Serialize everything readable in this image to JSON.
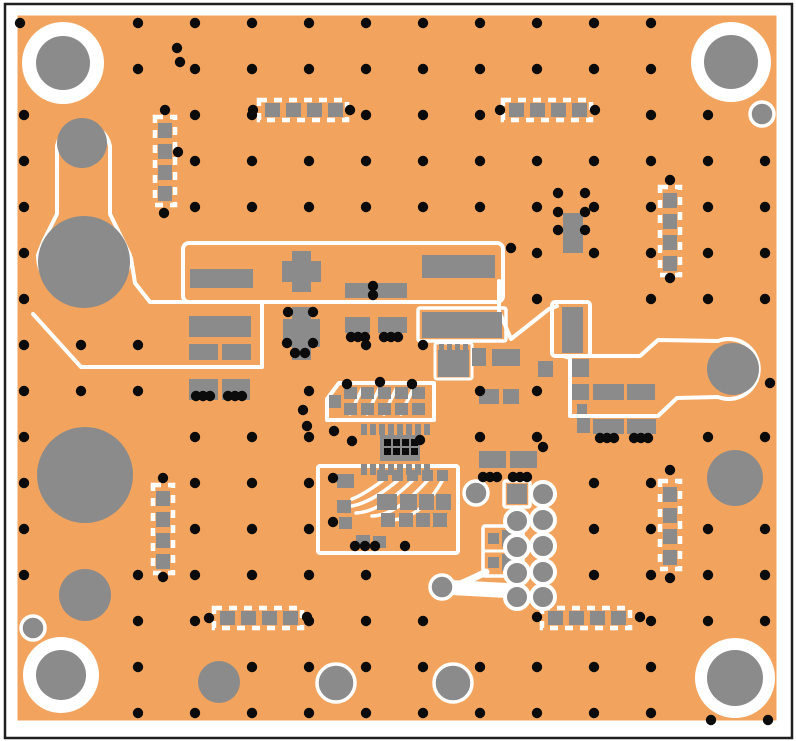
{
  "colors": {
    "bg": "#ffffff",
    "frame": "#1f1f1f",
    "board": "#f2a45e",
    "pad": "#8b8b8b",
    "silk": "#ffffff",
    "via": "#0b0b0b"
  },
  "frame": {
    "x": 5,
    "y": 4,
    "w": 787,
    "h": 734
  },
  "board": {
    "x": 16,
    "y": 14,
    "w": 762,
    "h": 708
  },
  "via_grid": {
    "x0": 24,
    "dx": 57,
    "cols": 14,
    "y0": 23,
    "dy": 46,
    "rows": 16,
    "r": 5.2
  },
  "via_exclusions": [
    [
      20,
      16,
      92,
      94
    ],
    [
      686,
      16,
      92,
      94
    ],
    [
      18,
      630,
      92,
      92
    ],
    [
      688,
      633,
      94,
      90
    ],
    [
      744,
      96,
      36,
      36
    ],
    [
      14,
      610,
      40,
      36
    ],
    [
      38,
      110,
      100,
      220
    ],
    [
      30,
      418,
      112,
      114
    ],
    [
      52,
      562,
      66,
      66
    ],
    [
      192,
      655,
      56,
      54
    ],
    [
      310,
      658,
      52,
      50
    ],
    [
      426,
      658,
      52,
      50
    ],
    [
      700,
      444,
      78,
      68
    ],
    [
      180,
      238,
      328,
      68
    ],
    [
      142,
      296,
      126,
      80
    ],
    [
      182,
      372,
      76,
      34
    ],
    [
      276,
      301,
      50,
      62
    ],
    [
      336,
      310,
      78,
      32
    ],
    [
      414,
      304,
      94,
      40
    ],
    [
      430,
      338,
      116,
      44
    ],
    [
      548,
      296,
      46,
      64
    ],
    [
      550,
      190,
      42,
      62
    ],
    [
      324,
      376,
      118,
      50
    ],
    [
      352,
      418,
      88,
      64
    ],
    [
      312,
      458,
      152,
      100
    ],
    [
      474,
      444,
      68,
      38
    ],
    [
      476,
      476,
      76,
      146
    ],
    [
      418,
      563,
      120,
      42
    ],
    [
      560,
      330,
      222,
      94
    ],
    [
      566,
      350,
      104,
      98
    ],
    [
      148,
      108,
      34,
      106
    ],
    [
      254,
      96,
      100,
      28
    ],
    [
      497,
      96,
      100,
      28
    ],
    [
      654,
      178,
      34,
      106
    ],
    [
      146,
      476,
      34,
      110
    ],
    [
      654,
      468,
      34,
      112
    ],
    [
      208,
      604,
      100,
      28
    ],
    [
      535,
      604,
      104,
      28
    ]
  ],
  "extra_vias": [
    [
      165,
      110
    ],
    [
      164,
      213
    ],
    [
      670,
      180
    ],
    [
      670,
      278
    ],
    [
      163,
      478
    ],
    [
      163,
      577
    ],
    [
      670,
      470
    ],
    [
      670,
      578
    ],
    [
      209,
      618
    ],
    [
      307,
      617
    ],
    [
      537,
      617
    ],
    [
      640,
      617
    ],
    [
      253,
      110
    ],
    [
      350,
      110
    ],
    [
      500,
      110
    ],
    [
      595,
      110
    ],
    [
      373,
      286
    ],
    [
      373,
      295
    ],
    [
      511,
      248
    ],
    [
      288,
      312
    ],
    [
      313,
      312
    ],
    [
      287,
      343
    ],
    [
      313,
      343
    ],
    [
      295,
      353
    ],
    [
      305,
      353
    ],
    [
      351,
      337
    ],
    [
      358,
      337
    ],
    [
      365,
      337
    ],
    [
      384,
      337
    ],
    [
      391,
      337
    ],
    [
      398,
      337
    ],
    [
      196,
      396
    ],
    [
      203,
      396
    ],
    [
      210,
      396
    ],
    [
      228,
      396
    ],
    [
      235,
      396
    ],
    [
      242,
      396
    ],
    [
      600,
      438
    ],
    [
      607,
      438
    ],
    [
      614,
      438
    ],
    [
      634,
      438
    ],
    [
      641,
      438
    ],
    [
      648,
      438
    ],
    [
      558,
      193
    ],
    [
      585,
      193
    ],
    [
      558,
      212
    ],
    [
      585,
      212
    ],
    [
      558,
      230
    ],
    [
      585,
      230
    ],
    [
      347,
      384
    ],
    [
      380,
      382
    ],
    [
      412,
      384
    ],
    [
      303,
      410
    ],
    [
      307,
      426
    ],
    [
      334,
      431
    ],
    [
      352,
      441
    ],
    [
      420,
      440
    ],
    [
      483,
      477
    ],
    [
      490,
      477
    ],
    [
      497,
      477
    ],
    [
      513,
      477
    ],
    [
      520,
      477
    ],
    [
      527,
      477
    ],
    [
      333,
      522
    ],
    [
      355,
      546
    ],
    [
      365,
      546
    ],
    [
      375,
      546
    ],
    [
      405,
      546
    ],
    [
      333,
      478
    ],
    [
      177,
      48
    ],
    [
      180,
      62
    ],
    [
      543,
      447
    ],
    [
      770,
      383
    ],
    [
      711,
      720
    ],
    [
      768,
      720
    ],
    [
      20,
      23
    ],
    [
      178,
      152
    ]
  ],
  "mount_holes": [
    {
      "name": "mounting-hole-top-left",
      "cx": 63,
      "cy": 63,
      "ring_r": 41,
      "hole_r": 27
    },
    {
      "name": "mounting-hole-top-right",
      "cx": 731,
      "cy": 62,
      "ring_r": 40,
      "hole_r": 27
    },
    {
      "name": "mounting-hole-bottom-left",
      "cx": 61,
      "cy": 675,
      "ring_r": 38,
      "hole_r": 25
    },
    {
      "name": "mounting-hole-bottom-right",
      "cx": 735,
      "cy": 678,
      "ring_r": 40,
      "hole_r": 28
    }
  ],
  "ringed_circles": [
    [
      762,
      114,
      12
    ],
    [
      33,
      628,
      12
    ],
    [
      336,
      683,
      19
    ],
    [
      453,
      683,
      19
    ],
    [
      476,
      493,
      12
    ],
    [
      442,
      587,
      12
    ]
  ],
  "plain_circles": [
    [
      82,
      143,
      25
    ],
    [
      84,
      262,
      46
    ],
    [
      85,
      475,
      48
    ],
    [
      85,
      595,
      26
    ],
    [
      219,
      682,
      21
    ],
    [
      733,
      369,
      26
    ],
    [
      735,
      478,
      28
    ]
  ],
  "silk_paths": [
    {
      "d": "M57,146 A27,27 0 0 1 110,146 L110,214 L130,255 A46,46 0 1 1 38,255 L44,240 L57,214 Z",
      "w": 4
    },
    {
      "d": "M33,314 L81,367 L262,367 L262,302 L150,302 L135,283 L131,258",
      "w": 4
    },
    {
      "d": "M499,281 L499,311 L511,339 L549,309 L557,306",
      "w": 4
    },
    {
      "d": "M563,356 L640,356 L658,340 L718,341 A30,30 0 1 1 718,397 L677,398 L658,416 L570,416 L570,358 Z",
      "w": 4
    },
    {
      "d": "M327,420 L327,399 L339,383 L434,383 L434,420 Z",
      "w": 4
    },
    {
      "d": "M350,414 L362,389",
      "w": 3.5
    },
    {
      "d": "M367,414 L379,389",
      "w": 3.5
    },
    {
      "d": "M384,414 L396,389",
      "w": 3.5
    },
    {
      "d": "M401,414 L413,389",
      "w": 3.5
    },
    {
      "d": "M382,481 Q363,495 352,499",
      "w": 3.5
    },
    {
      "d": "M397,481 Q372,502 352,506",
      "w": 3.5
    },
    {
      "d": "M412,481 Q380,512 356,513",
      "w": 3.5
    },
    {
      "d": "M427,481 Q395,516 372,516",
      "w": 3.5
    },
    {
      "d": "M442,481 Q420,520 390,520",
      "w": 3.5
    },
    {
      "d": "M486,572 Q464,583 452,587",
      "w": 7
    },
    {
      "d": "M442,587 L515,591",
      "w": 15
    },
    {
      "d": "M483,551 L523,551",
      "w": 3
    }
  ],
  "silk_rects": [
    [
      183,
      243,
      320,
      59,
      6,
      4
    ],
    [
      552,
      302,
      38,
      54,
      3,
      4
    ],
    [
      418,
      308,
      88,
      33,
      2,
      3.5
    ],
    [
      435,
      343,
      37,
      36,
      2,
      3
    ],
    [
      318,
      466,
      140,
      87,
      2,
      4
    ],
    [
      483,
      526,
      40,
      50,
      2,
      3.5
    ],
    [
      504,
      481,
      26,
      26,
      2,
      3.5
    ]
  ],
  "pads": [
    [
      190,
      269,
      63,
      19
    ],
    [
      345,
      283,
      62,
      15
    ],
    [
      422,
      255,
      73,
      23
    ],
    [
      292,
      251,
      19,
      41
    ],
    [
      282,
      261,
      39,
      21
    ],
    [
      189,
      316,
      62,
      21
    ],
    [
      189,
      344,
      29,
      16
    ],
    [
      222,
      344,
      29,
      16
    ],
    [
      189,
      379,
      29,
      21
    ],
    [
      222,
      379,
      28,
      21
    ],
    [
      292,
      307,
      19,
      53
    ],
    [
      283,
      319,
      37,
      28
    ],
    [
      345,
      317,
      25,
      16
    ],
    [
      378,
      317,
      29,
      16
    ],
    [
      422,
      312,
      80,
      26
    ],
    [
      438,
      350,
      31,
      27
    ],
    [
      439,
      344,
      5,
      7
    ],
    [
      447,
      344,
      5,
      7
    ],
    [
      455,
      344,
      5,
      7
    ],
    [
      463,
      344,
      5,
      7
    ],
    [
      472,
      348,
      14,
      18
    ],
    [
      492,
      349,
      28,
      17
    ],
    [
      538,
      361,
      15,
      16
    ],
    [
      479,
      389,
      20,
      15
    ],
    [
      503,
      389,
      16,
      15
    ],
    [
      562,
      307,
      21,
      46
    ],
    [
      563,
      213,
      20,
      40
    ],
    [
      572,
      359,
      17,
      18
    ],
    [
      572,
      384,
      17,
      16
    ],
    [
      577,
      404,
      10,
      10
    ],
    [
      577,
      418,
      13,
      15
    ],
    [
      593,
      384,
      31,
      16
    ],
    [
      627,
      384,
      28,
      16
    ],
    [
      593,
      419,
      31,
      15
    ],
    [
      627,
      419,
      29,
      15
    ],
    [
      479,
      451,
      27,
      17
    ],
    [
      510,
      451,
      27,
      17
    ],
    [
      344,
      387,
      13,
      12
    ],
    [
      361,
      387,
      13,
      12
    ],
    [
      378,
      387,
      13,
      12
    ],
    [
      395,
      387,
      13,
      12
    ],
    [
      412,
      387,
      13,
      12
    ],
    [
      344,
      403,
      13,
      12
    ],
    [
      361,
      403,
      13,
      12
    ],
    [
      378,
      403,
      13,
      12
    ],
    [
      395,
      403,
      13,
      12
    ],
    [
      412,
      403,
      13,
      12
    ],
    [
      329,
      395,
      12,
      13
    ],
    [
      377,
      470,
      11,
      11
    ],
    [
      392,
      470,
      11,
      11
    ],
    [
      407,
      470,
      11,
      11
    ],
    [
      422,
      470,
      11,
      11
    ],
    [
      437,
      470,
      11,
      11
    ],
    [
      377,
      494,
      20,
      16
    ],
    [
      400,
      494,
      17,
      16
    ],
    [
      419,
      494,
      15,
      16
    ],
    [
      436,
      494,
      15,
      16
    ],
    [
      381,
      513,
      14,
      14
    ],
    [
      399,
      513,
      14,
      14
    ],
    [
      416,
      513,
      14,
      14
    ],
    [
      433,
      513,
      14,
      14
    ],
    [
      337,
      474,
      17,
      14
    ],
    [
      337,
      500,
      14,
      13
    ],
    [
      339,
      517,
      13,
      12
    ],
    [
      356,
      535,
      14,
      12
    ],
    [
      373,
      536,
      13,
      12
    ],
    [
      488,
      533,
      11,
      11
    ],
    [
      488,
      557,
      11,
      11
    ],
    [
      502,
      530,
      21,
      17
    ],
    [
      502,
      554,
      21,
      17
    ],
    [
      507,
      484,
      20,
      20
    ]
  ],
  "qfn": {
    "base": [
      380,
      435,
      40,
      26
    ],
    "stripe_rows_y": [
      424,
      464
    ],
    "stripe_x0": 361,
    "stripe_n": 8,
    "stripe_step": 9,
    "stripe_w": 6,
    "stripe_h": 11,
    "via_x0": 384,
    "via_rows_y": [
      439,
      448
    ],
    "via_n": 4,
    "via_step": 9,
    "via_size": 7
  },
  "footprints": [
    {
      "cx": 303,
      "cy": 110,
      "orient": "h"
    },
    {
      "cx": 547,
      "cy": 110,
      "orient": "h"
    },
    {
      "cx": 165,
      "cy": 161,
      "orient": "v"
    },
    {
      "cx": 670,
      "cy": 231,
      "orient": "v"
    },
    {
      "cx": 163,
      "cy": 529,
      "orient": "v"
    },
    {
      "cx": 670,
      "cy": 525,
      "orient": "v"
    },
    {
      "cx": 258,
      "cy": 618,
      "orient": "h"
    },
    {
      "cx": 586,
      "cy": 618,
      "orient": "h"
    }
  ],
  "footprint_geom": {
    "len": 88,
    "body_w": 20,
    "pad": 15,
    "pad_th": 14,
    "dash": "8 7",
    "stroke": 4.5
  },
  "pin_header": {
    "left_col_x": 517,
    "left_col_rows": [
      521,
      547,
      573,
      597
    ],
    "right_col_x": 543,
    "right_col_rows": [
      494,
      520,
      546,
      572,
      597
    ],
    "r": 12
  }
}
